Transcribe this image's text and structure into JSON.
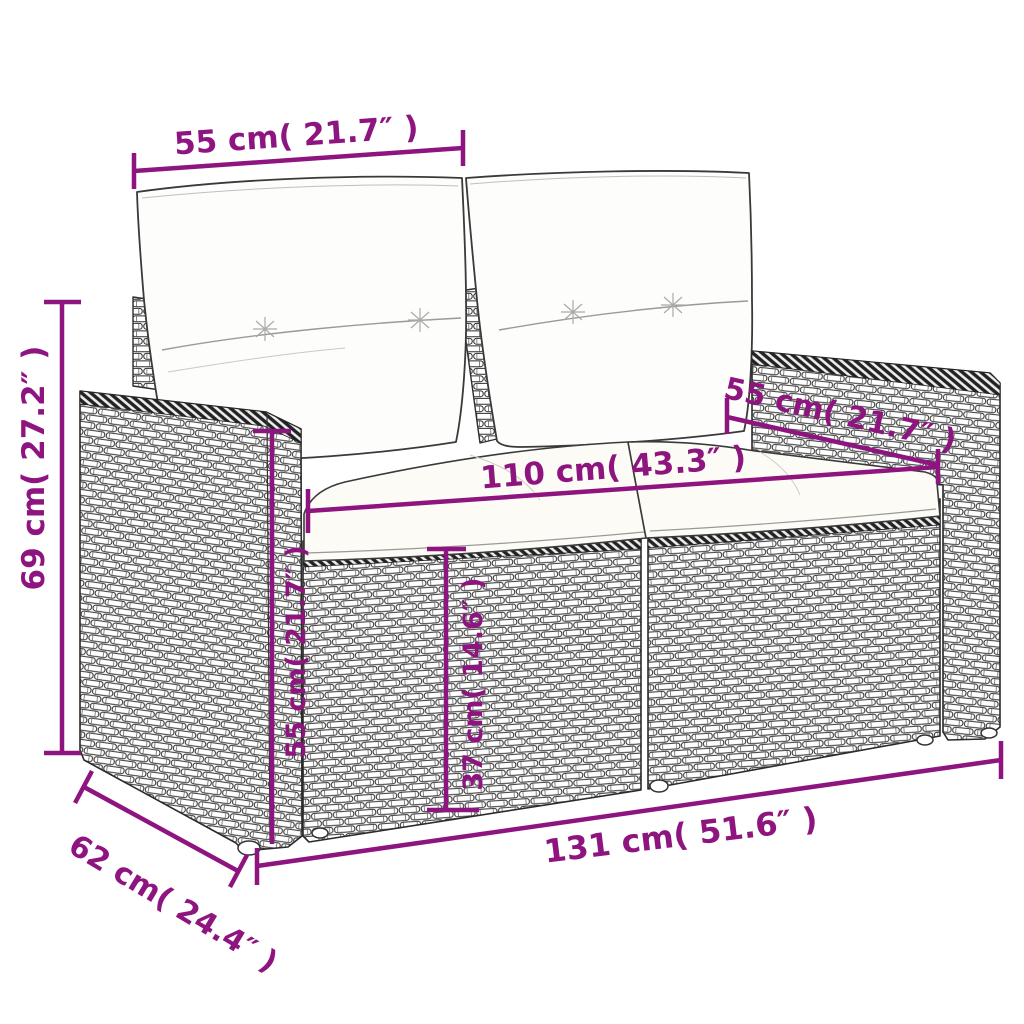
{
  "accent_color": "#8E1480",
  "illustration": {
    "subject": "poly rattan 2-seater garden sofa with back and seat cushions",
    "style": "black and white line drawing with woven rattan texture"
  },
  "dims": {
    "back_cushion_width": "55 cm( 21.7″ )",
    "overall_height": "69 cm( 27.2″ )",
    "armrest_top_depth": "55 cm( 21.7″ )",
    "seat_width": "110 cm( 43.3″ )",
    "armrest_height": "55 cm( 21.7″ )",
    "seat_height": "37 cm( 14.6″ )",
    "overall_width": "131 cm( 51.6″ )",
    "overall_depth": "62 cm( 24.4″ )"
  }
}
